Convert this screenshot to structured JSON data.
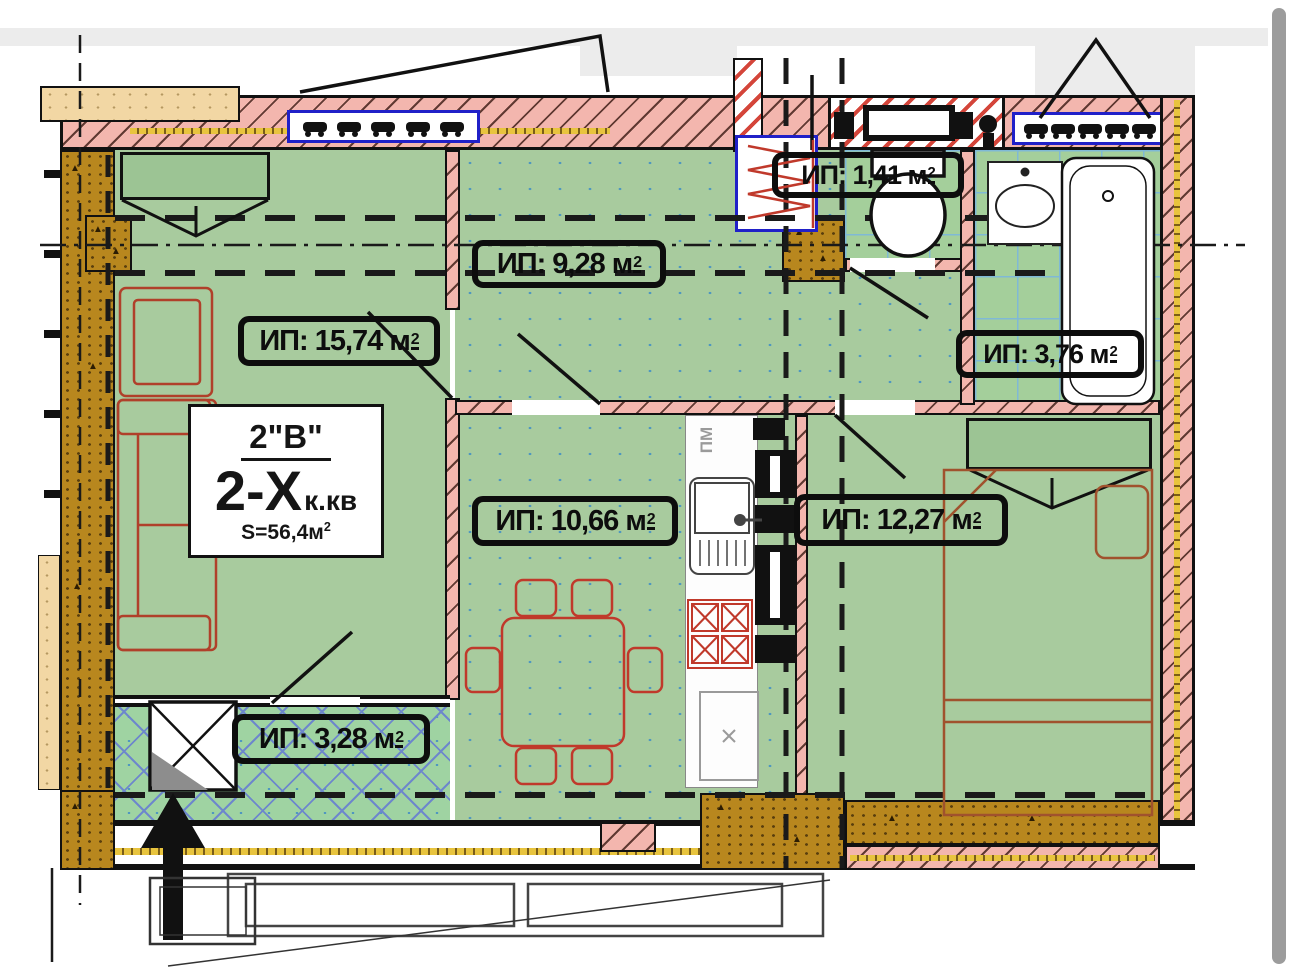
{
  "plan": {
    "apartment_card": {
      "type_code": "2\"В\"",
      "rooms_count": "2-Х",
      "rooms_suffix": "к.кв",
      "area_prefix": "S=56,4м",
      "area_sup": "2"
    },
    "area_labels": [
      {
        "room": "living-room",
        "prefix": "ИП: 15,74 м",
        "sup": "2"
      },
      {
        "room": "hallway",
        "prefix": "ИП: 9,28 м",
        "sup": "2"
      },
      {
        "room": "wc",
        "prefix": "ИП: 1,41 м",
        "sup": "2"
      },
      {
        "room": "bathroom",
        "prefix": "ИП: 3,76 м",
        "sup": "2"
      },
      {
        "room": "kitchen",
        "prefix": "ИП: 10,66 м",
        "sup": "2"
      },
      {
        "room": "bedroom",
        "prefix": "ИП: 12,27 м",
        "sup": "2"
      },
      {
        "room": "loggia",
        "prefix": "ИП: 3,28 м",
        "sup": "2"
      }
    ],
    "kitchen_appliance_label": "ПМ",
    "colors": {
      "floor_green": "#a8cb9e",
      "tile_green": "#a4cf9b",
      "wall_pink": "#f3b6ae",
      "stair_hatch_red": "#d4453a",
      "column_brown": "#b8871e",
      "insulation_yellow": "#e8c43e",
      "window_frame_blue": "#2020c8",
      "furniture_red": "#b0402a",
      "scrollbar_gray": "#9c9c9c"
    }
  }
}
